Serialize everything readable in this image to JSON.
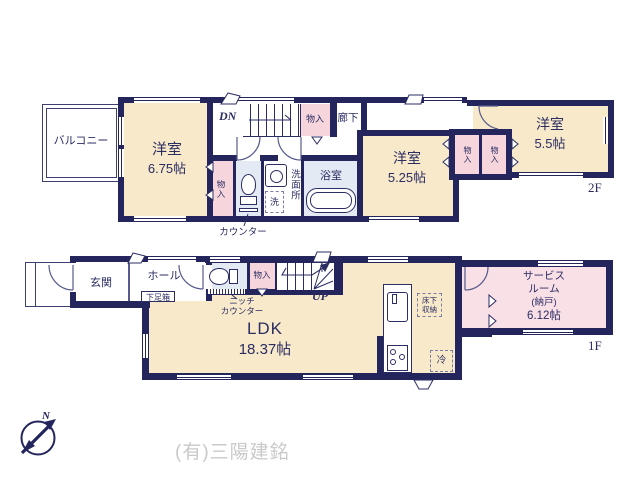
{
  "colors": {
    "wall": "#23255c",
    "room_cream": "#f7e9c9",
    "closet_pink": "#f6d6dc",
    "service_pink": "#f9dfe6",
    "wet_blue": "#e3eaf4",
    "text_navy": "#2b2d63",
    "company_gray": "#c9c9c9"
  },
  "compass": {
    "n": "N"
  },
  "company": "(有)三陽建銘",
  "floor2": {
    "floor_label": "2F",
    "balcony": "バルコニー",
    "room_675": {
      "name": "洋室",
      "size": "6.75帖"
    },
    "stairs": "DN",
    "closet_stairs": "物入",
    "hallway": "廊下",
    "closet_bedroom": "物入",
    "counter": "カウンター",
    "washroom": "洗面所",
    "laundry": "洗",
    "bath": "浴室",
    "room_525": {
      "name": "洋室",
      "size": "5.25帖"
    },
    "closet_a": "物入",
    "closet_b": "物入",
    "room_55": {
      "name": "洋室",
      "size": "5.5帖"
    }
  },
  "floor1": {
    "floor_label": "1F",
    "entrance": "玄関",
    "hall": "ホール",
    "shoe_box": "下足箱",
    "niche_counter_line1": "ニッチ",
    "niche_counter_line2": "カウンター",
    "closet_hall": "物入",
    "stairs": "UP",
    "ldk": {
      "name": "LDK",
      "size": "18.37帖"
    },
    "floor_storage_line1": "床下",
    "floor_storage_line2": "収納",
    "fridge": "冷",
    "closet_service": "物入",
    "service_room": {
      "line1": "サービス",
      "line2": "ルーム",
      "line3": "(納戸)",
      "line4": "6.12帖"
    }
  }
}
